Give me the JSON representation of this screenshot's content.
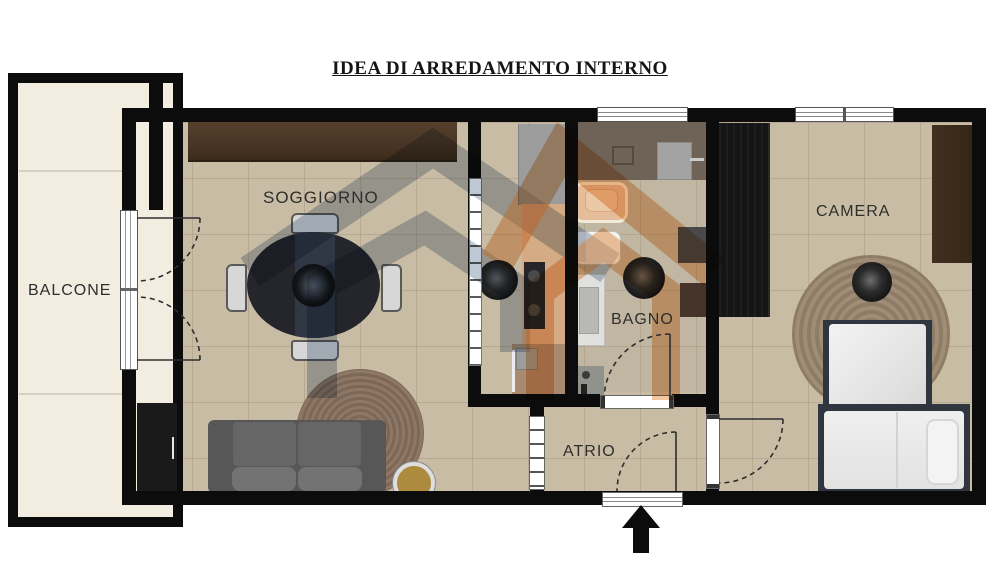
{
  "title": "IDEA DI ARREDAMENTO INTERNO",
  "rooms": {
    "balcone": {
      "label": "BALCONE"
    },
    "soggiorno": {
      "label": "SOGGIORNO"
    },
    "bagno": {
      "label": "BAGNO"
    },
    "camera": {
      "label": "CAMERA"
    },
    "atrio": {
      "label": "ATRIO"
    }
  },
  "icons": {
    "entrance_arrow": "up-arrow",
    "watermark_logo": "two-overlapping-houses"
  },
  "colors": {
    "wall": "#0c0c0c",
    "floor_tile": "#c8bca5",
    "balcony_floor": "#f2ece1",
    "bath_top_zone": "#6f6358",
    "watermark_blue": "#8093ab",
    "watermark_orange": "#e8984f",
    "sideboard_wood": "#4e3a28",
    "sofa_gray": "#5f5f5f",
    "label_text": "#2e2e2e"
  }
}
